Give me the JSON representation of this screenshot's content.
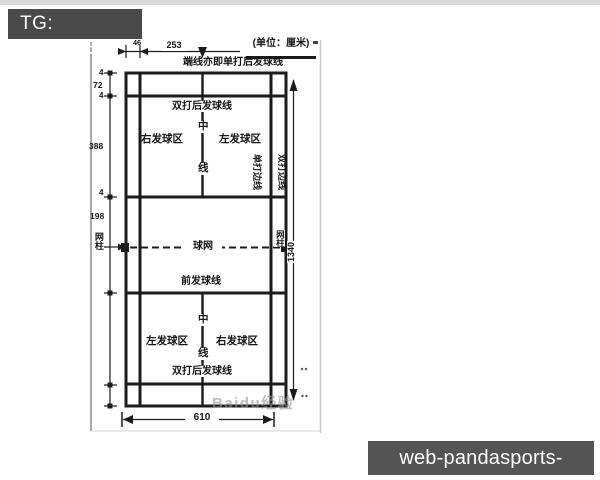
{
  "header": {
    "tag": "TG: MYYJJPP"
  },
  "footer": {
    "site": "web-pandasports-go.com"
  },
  "diagram": {
    "unit_note": "(单位：厘米)",
    "watermark": "Baidu经验",
    "labels": {
      "end_line": "端线亦即单打后发球线",
      "doubles_long_service_upper": "双打后发球线",
      "right_service_upper": "右发球区",
      "left_service_upper": "左发球区",
      "center_char_top": "中",
      "center_char_bottom": "线",
      "singles_sideline": "单打边线",
      "doubles_sideline": "双打边线",
      "net": "球网",
      "net_post_left": "网柱",
      "net_post_right": "网柱",
      "short_service_lower": "前发球线",
      "left_service_lower": "左发球区",
      "right_service_lower": "右发球区",
      "doubles_long_service_lower": "双打后发球线"
    },
    "dimensions": {
      "sideline_offset_cm": "46",
      "half_singles_width_cm": "253",
      "line_width_a": "4",
      "endline_to_doubles_service_cm": "72",
      "line_width_b": "4",
      "service_zone_length_cm": "388",
      "line_width_c": "4",
      "net_to_short_service_cm": "198",
      "court_length_cm": "1340",
      "court_width_cm": "610"
    }
  }
}
